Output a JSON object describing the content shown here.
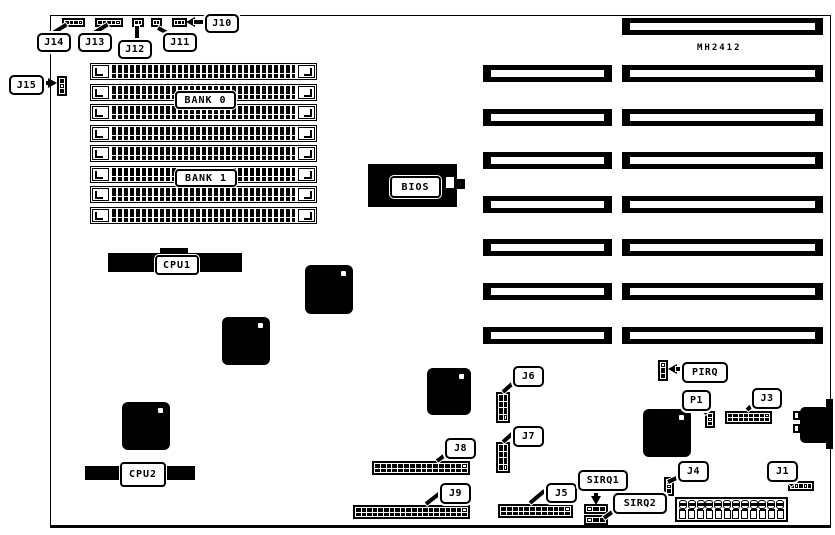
{
  "board": {
    "part_number": "MH2412",
    "ink_color": "#000000",
    "paper_color": "#ffffff"
  },
  "memory": {
    "slot_count": 8,
    "bank0_label": "BANK 0",
    "bank1_label": "BANK 1"
  },
  "expansion": {
    "eight_bit_slots": 1,
    "sixteen_bit_slots": 7
  },
  "chips": {
    "bios_label": "BIOS",
    "cpu1_label": "CPU1",
    "cpu2_label": "CPU2",
    "square_chip_count": 5
  },
  "power": {
    "pin_count": 12
  },
  "connectors": {
    "j14": {
      "label": "J14",
      "cols": 4,
      "rows": 1,
      "open": [
        3
      ]
    },
    "j13": {
      "label": "J13",
      "cols": 5,
      "rows": 1,
      "open": [
        4
      ]
    },
    "j12": {
      "label": "J12",
      "cols": 2,
      "rows": 1,
      "open": []
    },
    "j11": {
      "label": "J11",
      "cols": 2,
      "rows": 1,
      "open": []
    },
    "j10": {
      "label": "J10",
      "cols": 3,
      "rows": 1,
      "open": []
    },
    "j15": {
      "label": "J15",
      "cols": 1,
      "rows": 3,
      "open": [
        1
      ]
    },
    "j6": {
      "label": "J6",
      "cols": 2,
      "rows": 4,
      "open": [
        7
      ]
    },
    "j7": {
      "label": "J7",
      "cols": 2,
      "rows": 4,
      "open": [
        7
      ]
    },
    "j8": {
      "label": "J8",
      "cols": 16,
      "rows": 2,
      "open": [
        15
      ]
    },
    "j9": {
      "label": "J9",
      "cols": 20,
      "rows": 2,
      "open": [
        19
      ]
    },
    "j5": {
      "label": "J5",
      "cols": 12,
      "rows": 2,
      "open": [
        11
      ]
    },
    "j3": {
      "label": "J3",
      "cols": 8,
      "rows": 2,
      "open": [
        7
      ]
    },
    "j1": {
      "label": "J1",
      "cols": 5,
      "rows": 1,
      "open": [
        1,
        3
      ]
    },
    "j4": {
      "label": "J4",
      "cols": 1,
      "rows": 3,
      "open": [
        1
      ]
    },
    "p1": {
      "label": "P1",
      "cols": 1,
      "rows": 3,
      "open": [
        1
      ]
    },
    "pirq": {
      "label": "PIRQ",
      "cols": 1,
      "rows": 3,
      "open": [
        0
      ]
    },
    "sirq1": {
      "label": "SIRQ1",
      "cols": 3,
      "rows": 1,
      "open": [
        0
      ]
    },
    "sirq2": {
      "label": "SIRQ2",
      "cols": 3,
      "rows": 1,
      "open": [
        0
      ]
    }
  }
}
